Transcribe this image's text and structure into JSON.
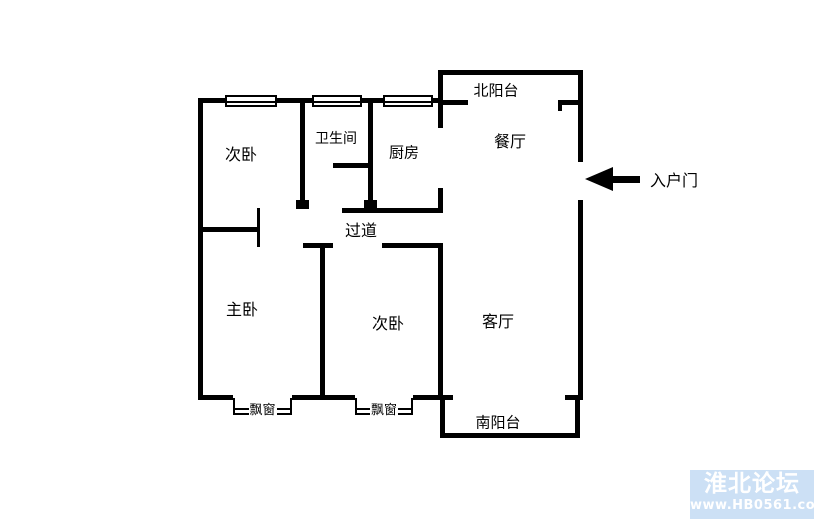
{
  "floorplan": {
    "rooms": {
      "bedroom_top": "次卧",
      "bathroom": "卫生间",
      "kitchen": "厨房",
      "north_balcony": "北阳台",
      "dining_room": "餐厅",
      "corridor": "过道",
      "master_bedroom": "主卧",
      "bedroom_bottom": "次卧",
      "living_room": "客厅",
      "south_balcony": "南阳台"
    },
    "bay_windows": {
      "left": "飘窗",
      "right": "飘窗"
    },
    "entry": {
      "label": "入户门"
    },
    "colors": {
      "wall": "#000000",
      "background": "#ffffff"
    }
  },
  "watermark": {
    "title": "淮北论坛",
    "url": "www.HB0561.com",
    "background_color": "#cce0f5",
    "text_color": "#ffffff"
  }
}
